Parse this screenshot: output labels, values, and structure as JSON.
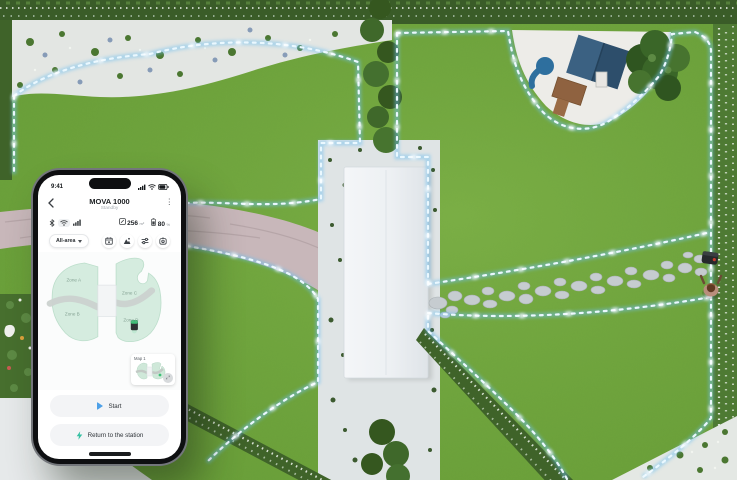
{
  "phone": {
    "status_bar": {
      "time": "9:41"
    },
    "header": {
      "title": "MOVA 1000",
      "subtitle": "Standby"
    },
    "device_status": {
      "connectivity_icons": [
        "bluetooth-icon",
        "wifi-icon",
        "cellular-icon"
      ],
      "area_value": "256",
      "area_unit": "m²",
      "battery_value": "80",
      "battery_unit": "%"
    },
    "toolbar": {
      "mode_selector_label": "All-area",
      "buttons": [
        {
          "icon": "schedule-icon"
        },
        {
          "icon": "zones-icon"
        },
        {
          "icon": "settings-icon"
        },
        {
          "icon": "remote-control-icon"
        }
      ]
    },
    "map": {
      "zones": [
        {
          "label": "Zone A"
        },
        {
          "label": "Zone B"
        },
        {
          "label": "Zone C"
        },
        {
          "label": "Zone D"
        }
      ],
      "map_card_label": "Map 1"
    },
    "actions": {
      "start_label": "Start",
      "return_label": "Return to the station"
    }
  },
  "scene": {
    "colors": {
      "lawn": "#6FA43C",
      "boundary_glow": "#9FD7F5",
      "boundary_dash": "#EAF8FF",
      "roof": "#EFF2F4",
      "cobble_path": "#C8B7BA",
      "stepping_stone": "#C6CCD0",
      "sand": "#EDECE8",
      "hedge": "#3A5C28",
      "mint_zone": "#D5ECDF",
      "accent_blue": "#4DA0E8",
      "accent_teal": "#35C0A2"
    }
  }
}
